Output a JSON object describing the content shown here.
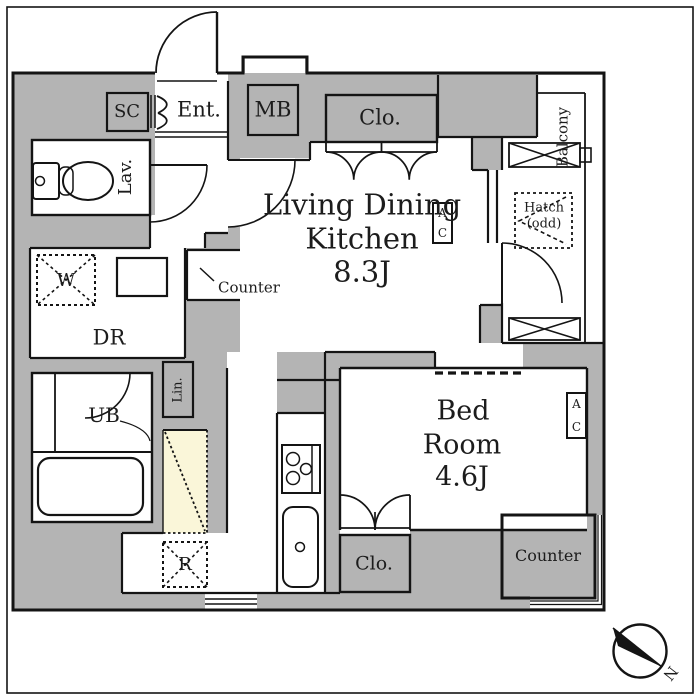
{
  "title": "apartment floor plan",
  "colors": {
    "wall_gray": "#b4b4b4",
    "accent_cream": "#faf6d9",
    "line": "#141414",
    "background": "#ffffff"
  },
  "rooms": {
    "ldk": {
      "line1": "Living Dining",
      "line2": "Kitchen",
      "line3": "8.3J"
    },
    "bedroom": {
      "line1": "Bed",
      "line2": "Room",
      "line3": "4.6J"
    }
  },
  "labels": {
    "sc": "SC",
    "ent": "Ent.",
    "mb": "MB",
    "clo_ldk": "Clo.",
    "balcony": "Balcony",
    "hatch_line1": "Hatch",
    "hatch_line2": "(odd)",
    "ac_top": "A",
    "ac_bottom": "C",
    "lav": "Lav.",
    "counter_kitchen": "Counter",
    "w": "W",
    "dr": "DR",
    "ub": "UB",
    "lin": "Lin.",
    "r": "R",
    "clo_bed": "Clo.",
    "counter_bed": "Counter",
    "north": "N"
  }
}
